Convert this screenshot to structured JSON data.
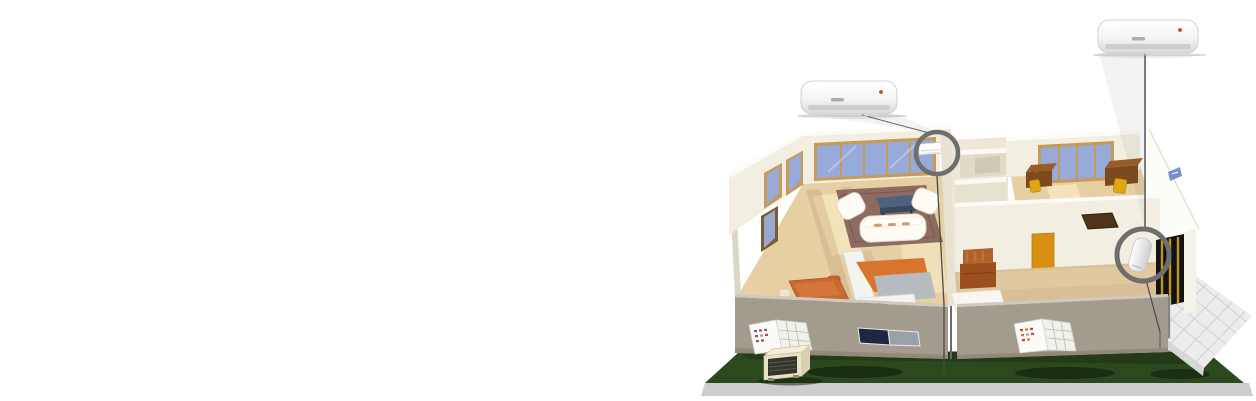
{
  "scene": {
    "kind": "product-illustration",
    "subject": "cutaway house with multi-split air conditioning system",
    "background": "#ffffff",
    "regions": {
      "left_area": "empty white space",
      "right_area": "isometric cutaway house on green lawn"
    }
  },
  "palette": {
    "lawn": "#2c481f",
    "lawn_shadow": "#15240e",
    "ground_base": "#cdcdcd",
    "patio_tile": "#ececec",
    "patio_grid": "#c9c9c9",
    "wall_cream": "#f2eee1",
    "wall_cap": "#fcfbf6",
    "wall_inner": "#e8e2d0",
    "wall_bright": "#fdfdf8",
    "facade": "#a39b8d",
    "facade_trim": "#cfcabf",
    "floor_wood": "#e6cfa2",
    "floor_wood_dark": "#d9bf97",
    "floor_sun": "#f4e4bd",
    "window_glass": "#97aada",
    "window_frame": "#c79a55",
    "rug": "#8d6b60",
    "sofa": "#fdfbf4",
    "tv_bench": "#4e6280",
    "dining_table": "#c9682f",
    "counter_orange": "#d8742e",
    "counter_gray": "#b6bbbf",
    "counter_white": "#f3f3ef",
    "desk_brown": "#7c4a1e",
    "desk_top": "#9a5c26",
    "chair_yellow": "#e2a613",
    "chair_brown": "#9c4f1f",
    "door_orange": "#d99012",
    "doorway_dark": "#121210",
    "doorway_frame": "#c0951e",
    "mat_brown": "#4f3517",
    "ac_body": "#ffffff",
    "ac_flap": "#c8c8c8",
    "ac_indicator": "#e04010",
    "ac_logo": "#a0a0a0",
    "ring": "#6e6e6e",
    "pipe": "#4a4a4a",
    "outdoor_body": "#eae2c6",
    "outdoor_grille": "#35342c"
  },
  "units": {
    "indoor_render_left": {
      "kind": "wall-mounted split AC render",
      "position": "above living room"
    },
    "indoor_render_right": {
      "kind": "wall-mounted split AC render",
      "position": "above right corner"
    },
    "indoor_installed_left": {
      "kind": "installed indoor unit",
      "room": "living room back wall"
    },
    "indoor_installed_right": {
      "kind": "installed indoor unit",
      "room": "corner entry wall"
    },
    "outdoor_condenser": {
      "kind": "outdoor condenser unit",
      "position": "front lawn, left"
    }
  },
  "callouts": [
    {
      "id": "living-room-unit-ring",
      "shape": "circle"
    },
    {
      "id": "corner-unit-ring",
      "shape": "circle"
    }
  ]
}
